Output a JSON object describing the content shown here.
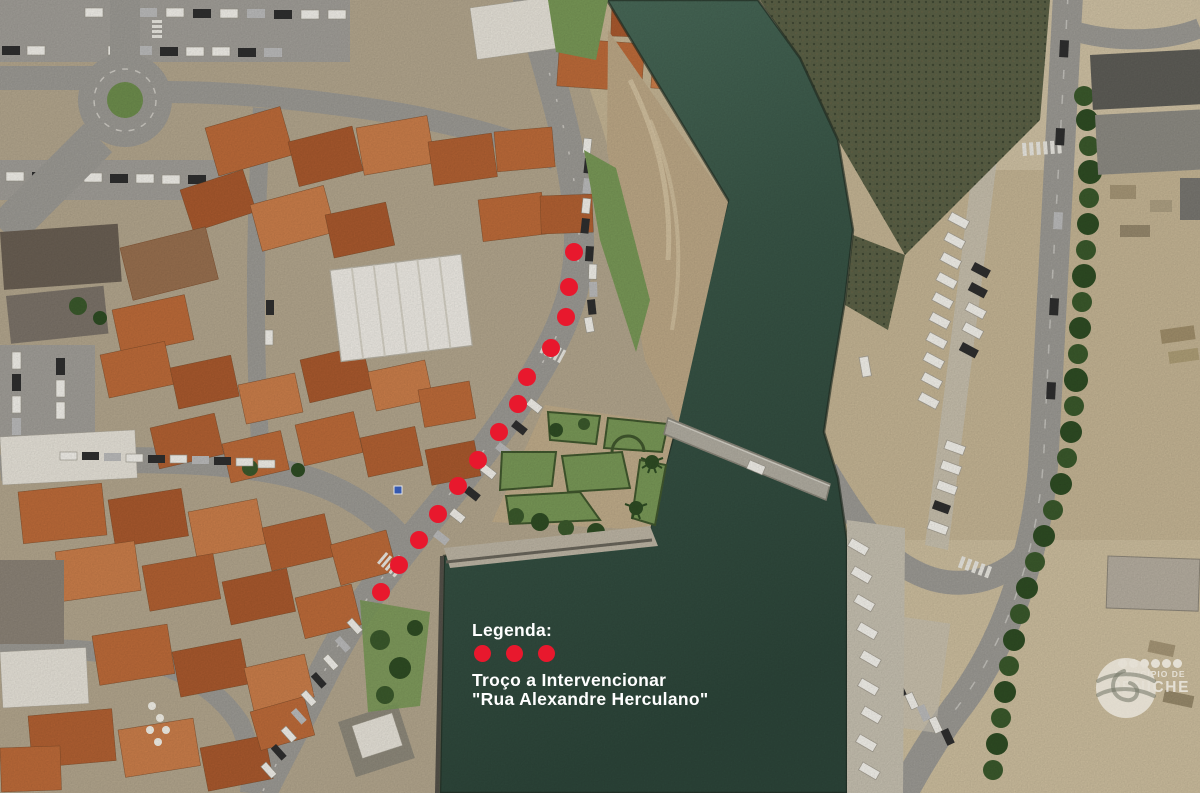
{
  "legend": {
    "heading": "Legenda:",
    "dots_count": 3,
    "line1": "Troço a Intervencionar",
    "line2": "\"Rua Alexandre Herculano\""
  },
  "markers": {
    "color": "#e8182d",
    "radius": 9,
    "road_dots": [
      [
        574,
        252
      ],
      [
        569,
        287
      ],
      [
        566,
        317
      ],
      [
        551,
        348
      ],
      [
        527,
        377
      ],
      [
        518,
        404
      ],
      [
        499,
        432
      ],
      [
        478,
        460
      ],
      [
        458,
        486
      ],
      [
        438,
        514
      ],
      [
        419,
        540
      ],
      [
        399,
        565
      ],
      [
        381,
        592
      ]
    ]
  },
  "watermark": {
    "dots_count": 6,
    "line1": "MUNICÍPIO DE",
    "line2": "PENICHE"
  },
  "palette": {
    "marker_red": "#e8182d",
    "water_dark": "#2d463a",
    "water_light": "#4d6f5d",
    "sand": "#c7b796",
    "roof_orange": "#bf6c3a",
    "road_gray": "#9e9c96",
    "lawn_green": "#7a9a58",
    "legend_text": "#ffffff"
  }
}
